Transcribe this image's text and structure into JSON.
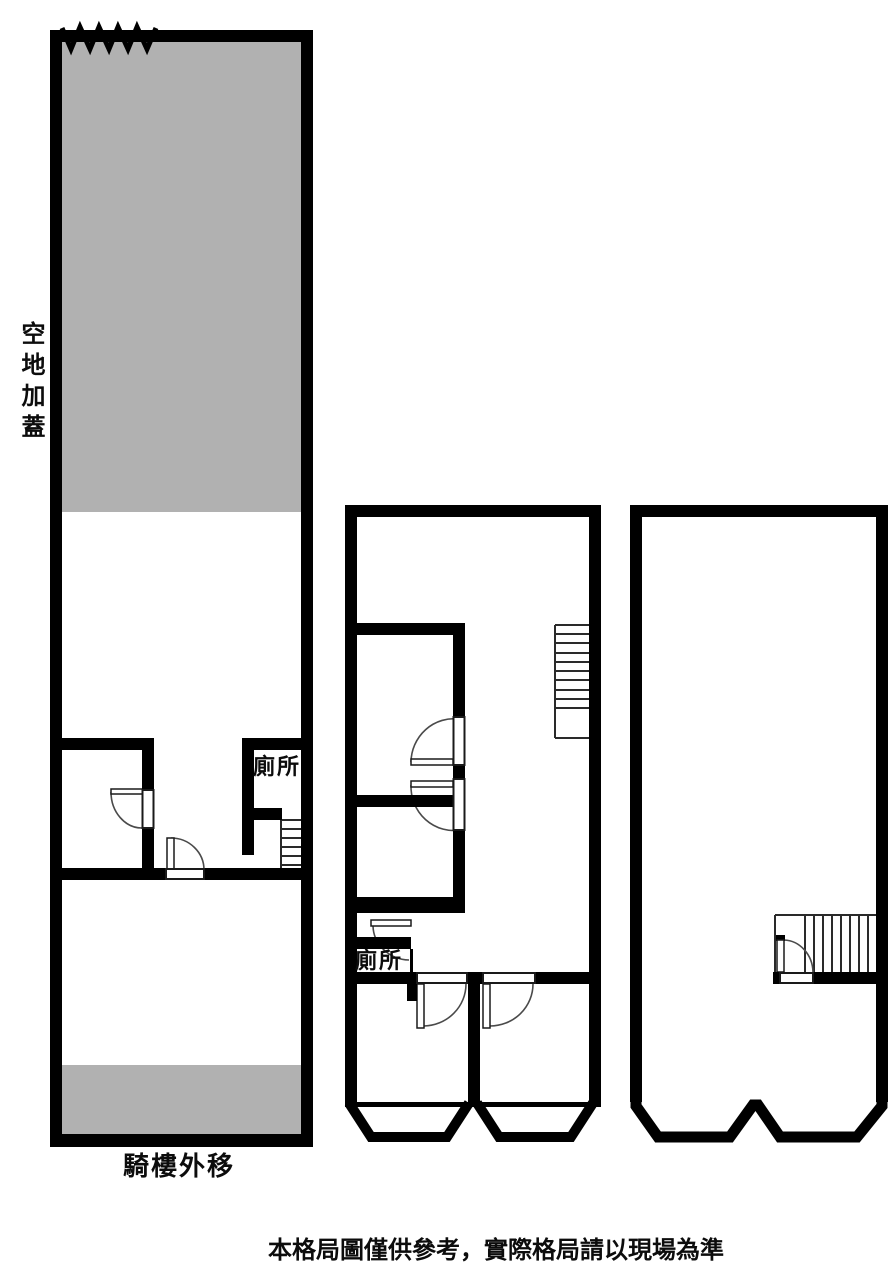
{
  "colors": {
    "wall": "#000000",
    "shaded_area": "#b1b1b1",
    "background": "#ffffff",
    "arc_line": "#4a4a4a"
  },
  "left_plan": {
    "area_label": "空地加蓋",
    "toilet_label": "廁所",
    "bottom_label": "騎樓外移"
  },
  "middle_plan": {
    "toilet_label": "廁所"
  },
  "footer": {
    "disclaimer": "本格局圖僅供參考，實際格局請以現場為準"
  }
}
